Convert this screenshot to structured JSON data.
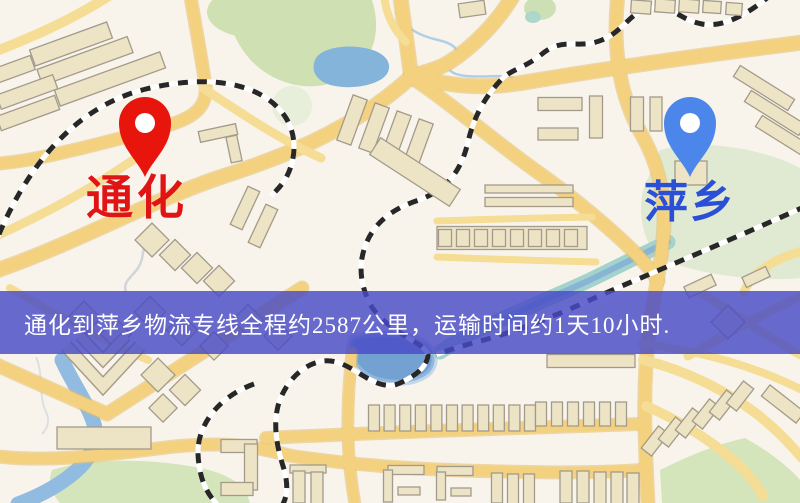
{
  "pins": {
    "origin": {
      "label": "通化",
      "pin_color": "#e8150c",
      "label_color": "#e01414"
    },
    "destination": {
      "label": "萍乡",
      "pin_color": "#4d86ea",
      "label_color": "#2b50d6"
    }
  },
  "banner": {
    "text": "通化到萍乡物流专线全程约2587公里，运输时间约1天10小时.",
    "background": "#484ac6",
    "text_color": "#ffffff"
  },
  "map_colors": {
    "background": "#f3efe7",
    "road_major": "#f1cd74",
    "road_minor": "#f3d98c",
    "building": "#e9e0c0",
    "building_outline": "#a09786",
    "park_green": "#cadcab",
    "pale_green": "#d6e3c6",
    "pond_blue": "#7fb1db",
    "lake_blue": "#6d9fd3",
    "river_teal": "#9ed0ca",
    "railway_dark": "#262626"
  }
}
